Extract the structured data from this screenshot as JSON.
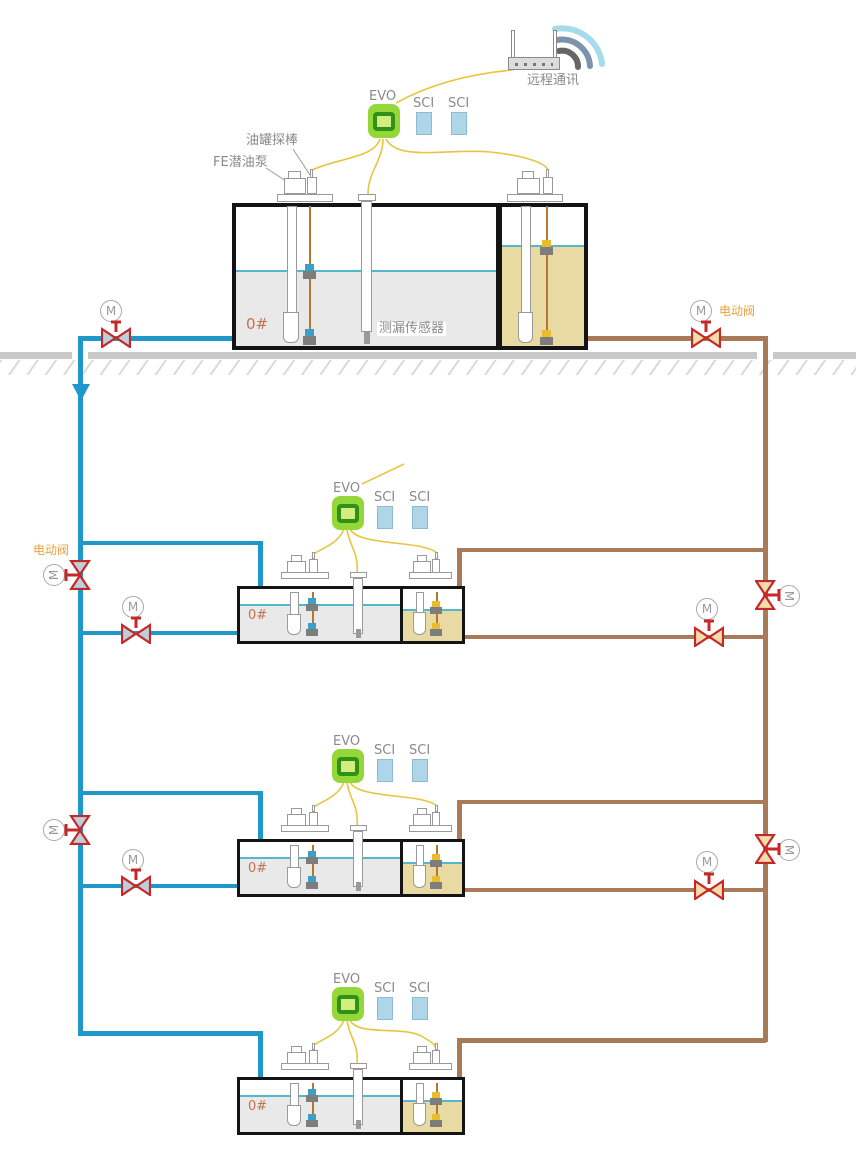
{
  "labels": {
    "remote_comm": "远程通讯",
    "evo": "EVO",
    "sci": "SCI",
    "tank_probe": "油罐探棒",
    "fe_pump": "FE潜油泵",
    "leak_sensor": "测漏传感器",
    "electric_valve": "电动阀",
    "fuel_grade": "0#",
    "motor_mark": "M"
  },
  "colors": {
    "pipe_supply_blue": "#2097cb",
    "pipe_return_brown": "#a87a58",
    "valve_red": "#c62828",
    "valve_disc_blue": "#becfdc",
    "valve_disc_tan": "#f3ddab",
    "signal_wire_yellow": "#e6c63f",
    "evo_green": "#95d739",
    "sci_module_blue": "#aed6e8",
    "diesel_gray": "#e9e9e9",
    "gasoline_yellow": "#e9d9a2",
    "liquid_surface_cyan": "#53b7cd",
    "ground_gray": "#c9c9c9",
    "label_gray": "#8a8a8a",
    "label_orange": "#e9a33c",
    "fuel_grade_orange": "#c0734e"
  }
}
